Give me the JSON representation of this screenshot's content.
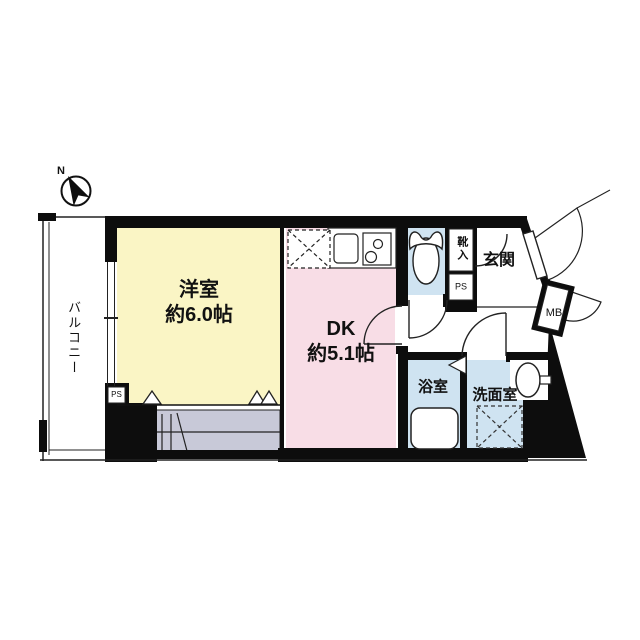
{
  "compass": {
    "north_label": "N"
  },
  "rooms": {
    "balcony": {
      "label": "バルコニー"
    },
    "western_room": {
      "name": "洋室",
      "size": "約6.0帖"
    },
    "dining_kitchen": {
      "name": "DK",
      "size": "約5.1帖"
    },
    "entrance": {
      "label": "玄関"
    },
    "bathroom": {
      "label": "浴室"
    },
    "washroom": {
      "label": "洗面室"
    },
    "shoe_cabinet": {
      "label": "靴入"
    }
  },
  "utility": {
    "pipe_space_hall": "PS",
    "pipe_space_room": "PS",
    "meter_box": "MB"
  },
  "colors": {
    "western_room": "#faf5c5",
    "dining_kitchen": "#f8dde6",
    "wet_area": "#cfe3f1",
    "closet": "#c8c9d8",
    "wall": "#0d0d0d"
  }
}
